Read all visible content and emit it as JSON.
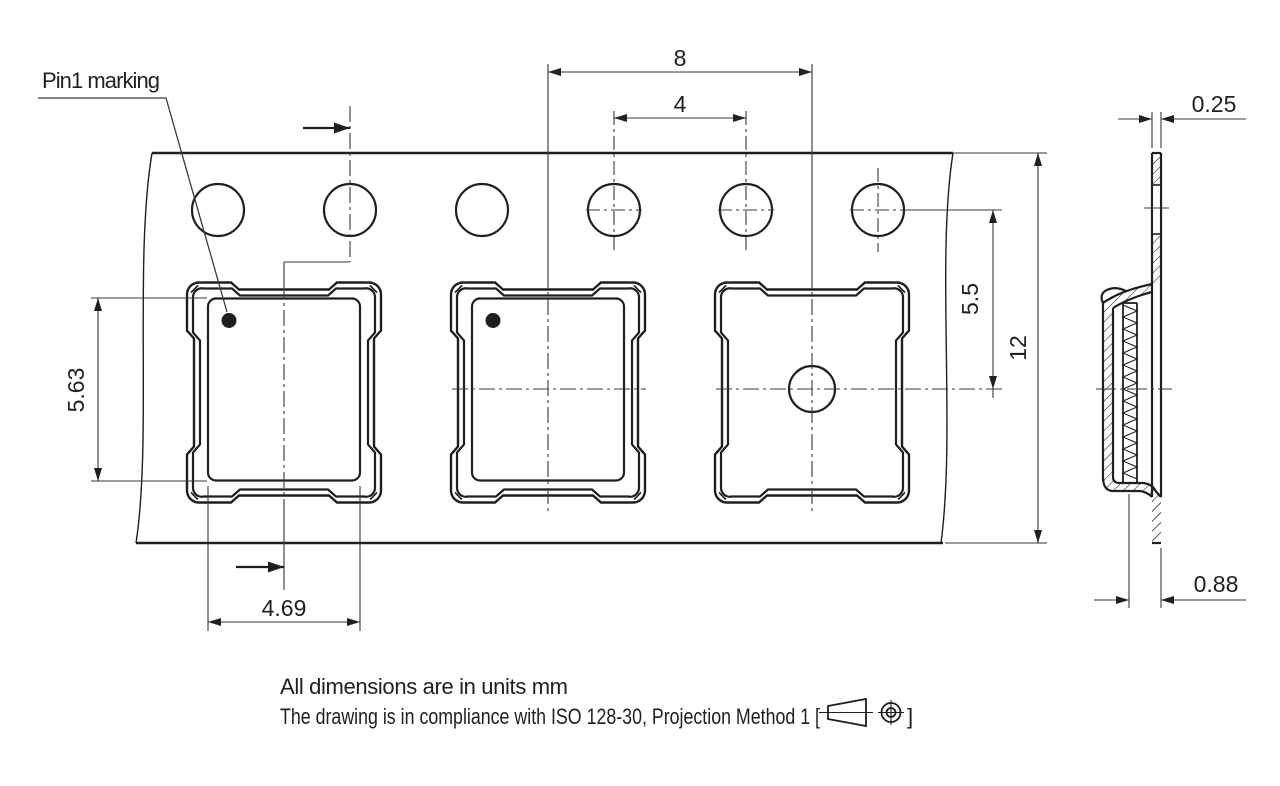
{
  "labels": {
    "pin1": "Pin1 marking"
  },
  "dimensions": {
    "pocket_pitch": "8",
    "hole_pitch": "4",
    "hole_to_pocket_center": "5.5",
    "tape_width": "12",
    "pocket_length": "5.63",
    "pocket_width": "4.69",
    "tape_thickness": "0.25",
    "overall_thickness": "0.88"
  },
  "notes": {
    "line1": "All dimensions are in units mm",
    "line2_prefix": "The drawing is in compliance with ISO 128-30, Projection Method 1 [",
    "line2_suffix": "]"
  },
  "icons": {
    "projection": "projection-method-1-icon"
  },
  "colors": {
    "line": "#1f1f1f",
    "thin": "#3a3a3a",
    "background": "#ffffff"
  }
}
